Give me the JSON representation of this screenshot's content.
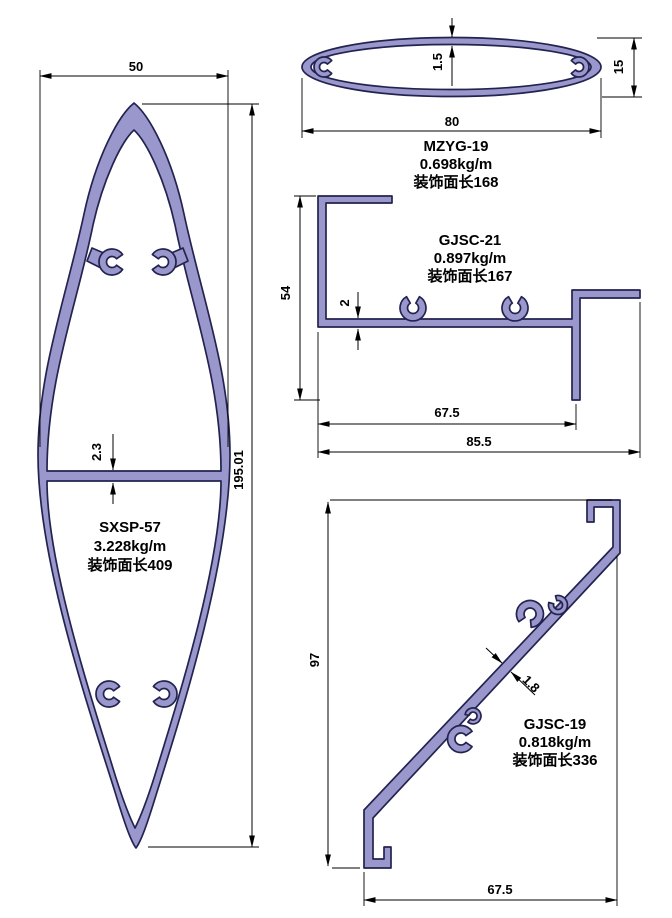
{
  "colors": {
    "fill": "#9a97cd",
    "outline": "#23234f",
    "dimension": "#000000",
    "background": "#ffffff"
  },
  "profiles": {
    "sxsp57": {
      "name": "SXSP-57",
      "weight": "3.228kg/m",
      "surface": "装饰面长409",
      "dim_width": "50",
      "dim_height": "195.01",
      "dim_web": "2.3"
    },
    "mzyg19": {
      "name": "MZYG-19",
      "weight": "0.698kg/m",
      "surface": "装饰面长168",
      "dim_width": "80",
      "dim_height": "15",
      "dim_wall": "1.5"
    },
    "gjsc21": {
      "name": "GJSC-21",
      "weight": "0.897kg/m",
      "surface": "装饰面长167",
      "dim_height": "54",
      "dim_web": "2",
      "dim_inner_width": "67.5",
      "dim_total_width": "85.5"
    },
    "gjsc19": {
      "name": "GJSC-19",
      "weight": "0.818kg/m",
      "surface": "装饰面长336",
      "dim_height": "97",
      "dim_wall": "1.8",
      "dim_width": "67.5"
    }
  }
}
